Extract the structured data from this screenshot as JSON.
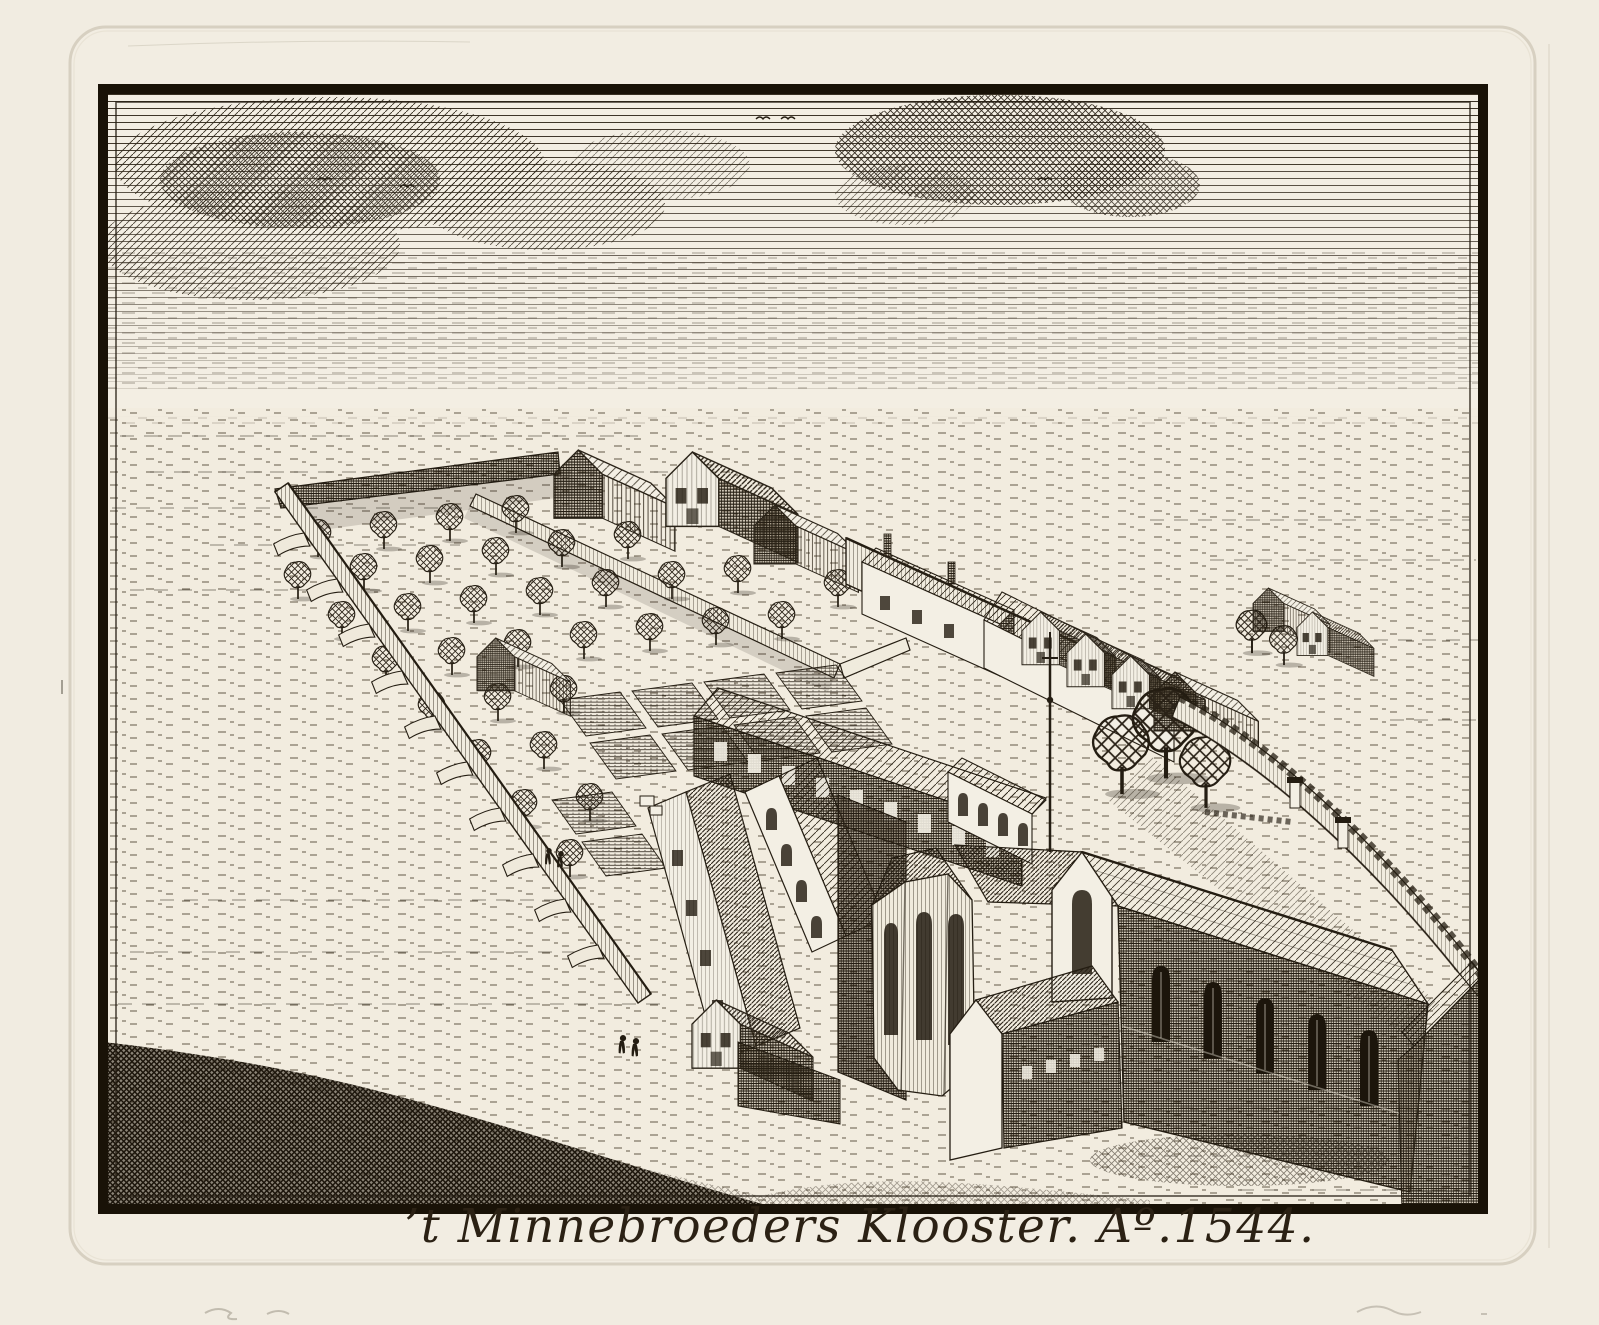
{
  "artwork": {
    "caption": "’t Minnebroeders Klooster. Aº.1544.",
    "title": "’t Minnebroeders Klooster",
    "year_label": "Aº.1544"
  },
  "palette": {
    "paper": "#f1ece1",
    "scene_paper": "#f3eee3",
    "ink": "#241d12",
    "plate_mark": "#d7d0c1"
  },
  "scene": {
    "type": "antique engraving",
    "subject": "Bird's-eye view of a walled friary with church, cloister, orchard and gardens"
  }
}
